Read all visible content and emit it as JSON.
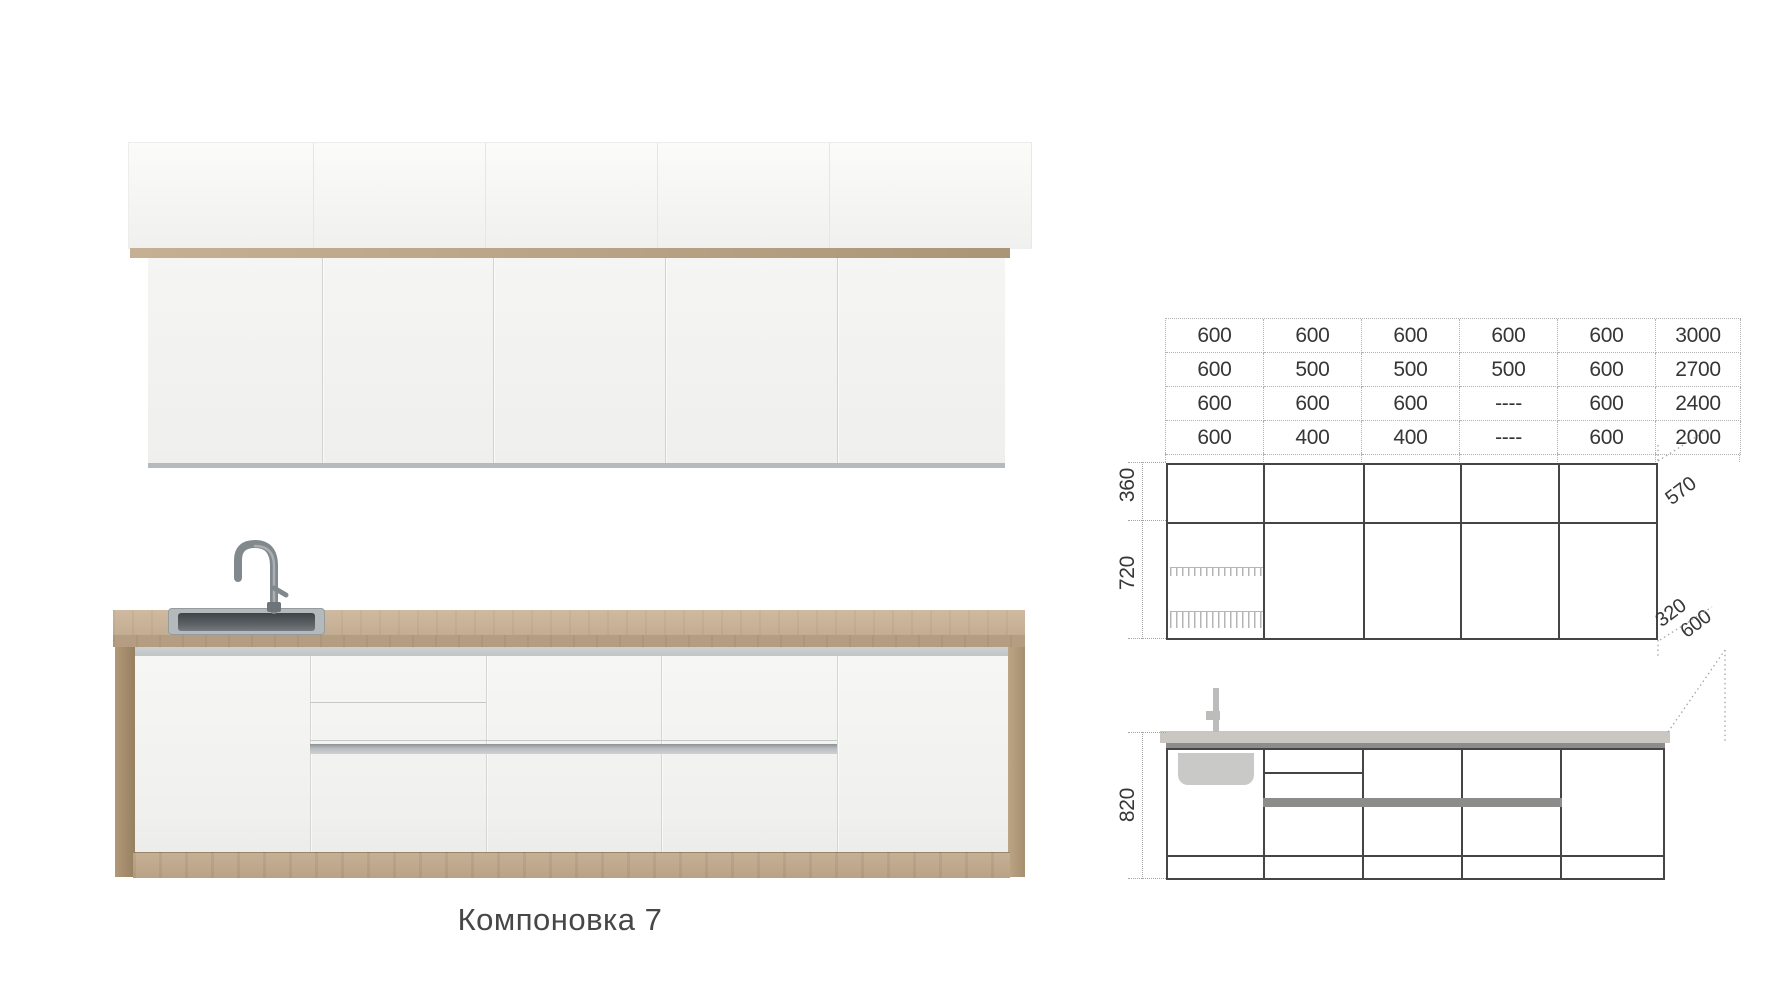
{
  "caption": "Компоновка 7",
  "palette": {
    "wood": "#c2ac90",
    "wood_dark": "#a8906f",
    "drawing_line": "#454545",
    "dotted_line": "#a5a5a5",
    "gray_bar": "#8c8c8a",
    "steel": "#868d91"
  },
  "size_table": {
    "rows": [
      [
        "600",
        "600",
        "600",
        "600",
        "600",
        "3000"
      ],
      [
        "600",
        "500",
        "500",
        "500",
        "600",
        "2700"
      ],
      [
        "600",
        "600",
        "600",
        "----",
        "600",
        "2400"
      ],
      [
        "600",
        "400",
        "400",
        "----",
        "600",
        "2000"
      ]
    ]
  },
  "upper_elevation": {
    "height_top": "360",
    "height_bottom": "720",
    "depth_top": "570",
    "depth_bottom": "320"
  },
  "lower_elevation": {
    "height": "820",
    "depth": "600"
  }
}
